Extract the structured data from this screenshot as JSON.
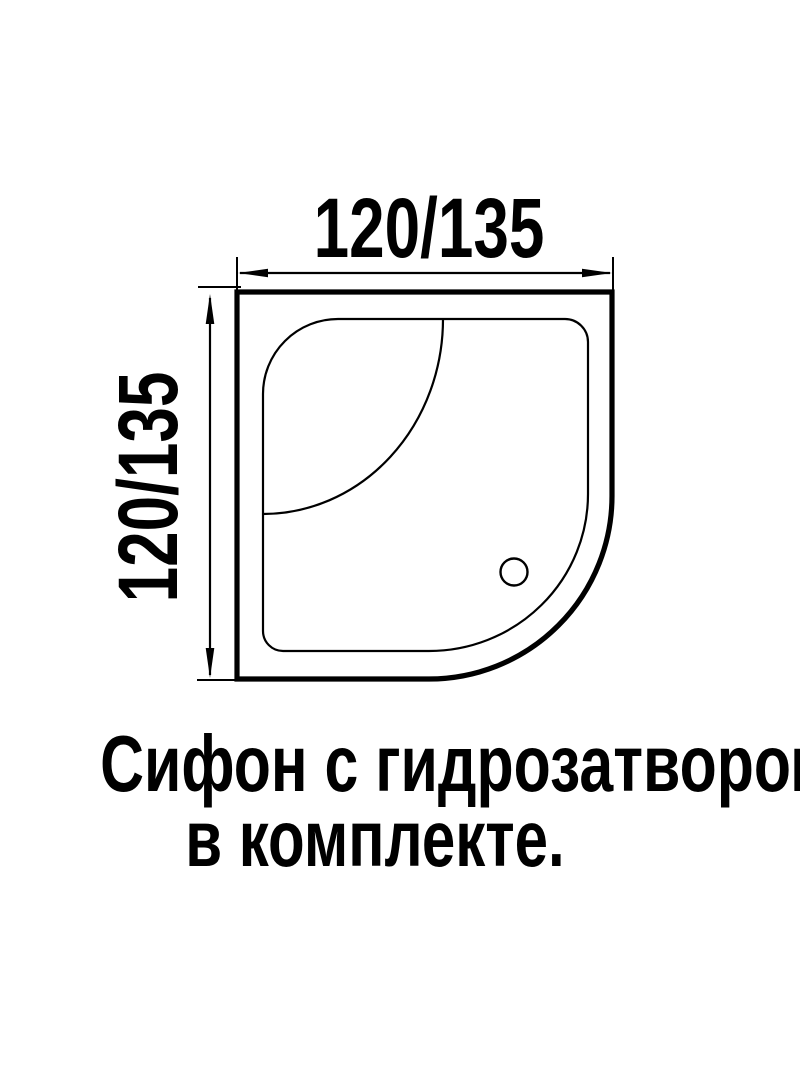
{
  "page": {
    "background_color": "#ffffff",
    "line_color": "#000000"
  },
  "dimensions": {
    "width_label": "120/135",
    "height_label": "120/135"
  },
  "caption": {
    "line1": "Сифон с гидрозатвором",
    "line2": "в комплекте."
  }
}
